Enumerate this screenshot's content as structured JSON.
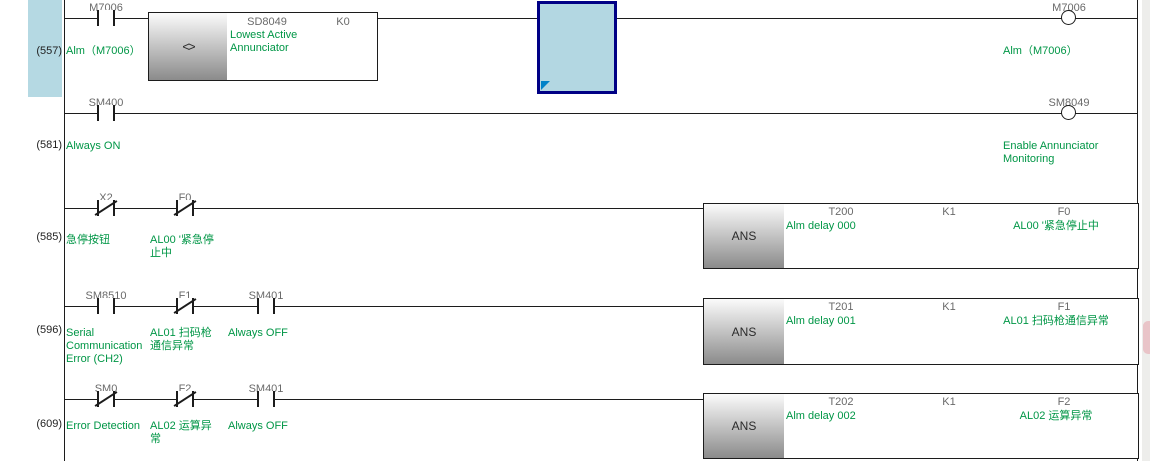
{
  "palette": {
    "comment_green": "#009646",
    "device_gray": "#6a6a6a",
    "line_black": "#1c1c1c",
    "cursor_fill": "#b3d7e2",
    "cursor_border": "#000085",
    "selection_margin_blue": "#b5d9e3",
    "right_margin_gray": "#ededeb"
  },
  "rungs": [
    {
      "number": "(557)",
      "contacts": [
        {
          "label": "M7006",
          "comment": "Alm（M7006）",
          "type": "NO"
        }
      ],
      "compare_block": {
        "operator": "<>",
        "operand1": "SD8049",
        "operand1_comment": "Lowest Active\nAnnunciator",
        "operand2": "K0"
      },
      "coil": {
        "label": "M7006",
        "comment": "Alm（M7006）"
      }
    },
    {
      "number": "(581)",
      "contacts": [
        {
          "label": "SM400",
          "comment": "Always ON",
          "type": "NO"
        }
      ],
      "coil": {
        "label": "SM8049",
        "comment": "Enable Annunciator\nMonitoring"
      }
    },
    {
      "number": "(585)",
      "contacts": [
        {
          "label": "X2",
          "comment": "急停按钮",
          "type": "NC"
        },
        {
          "label": "F0",
          "comment": "AL00 '紧急停\n止中",
          "type": "NC"
        }
      ],
      "ans_block": {
        "mnemonic": "ANS",
        "timer": "T200",
        "timer_comment": "Alm delay 000",
        "constant": "K1",
        "flag": "F0",
        "flag_comment": "AL00 '紧急停止中"
      }
    },
    {
      "number": "(596)",
      "contacts": [
        {
          "label": "SM8510",
          "comment": "Serial\nCommunication\nError (CH2)",
          "type": "NO"
        },
        {
          "label": "F1",
          "comment": "AL01 扫码枪\n通信异常",
          "type": "NC"
        },
        {
          "label": "SM401",
          "comment": "Always OFF",
          "type": "NO"
        }
      ],
      "ans_block": {
        "mnemonic": "ANS",
        "timer": "T201",
        "timer_comment": "Alm delay 001",
        "constant": "K1",
        "flag": "F1",
        "flag_comment": "AL01 扫码枪通信异常"
      }
    },
    {
      "number": "(609)",
      "contacts": [
        {
          "label": "SM0",
          "comment": "Error Detection",
          "type": "NC"
        },
        {
          "label": "F2",
          "comment": "AL02 运算异\n常",
          "type": "NC"
        },
        {
          "label": "SM401",
          "comment": "Always OFF",
          "type": "NO"
        }
      ],
      "ans_block": {
        "mnemonic": "ANS",
        "timer": "T202",
        "timer_comment": "Alm delay 002",
        "constant": "K1",
        "flag": "F2",
        "flag_comment": "AL02 运算异常"
      }
    }
  ]
}
